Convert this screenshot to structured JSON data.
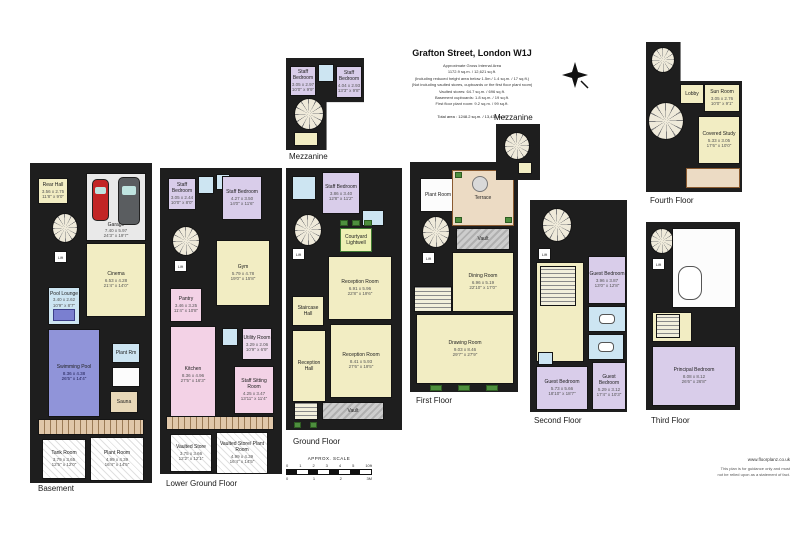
{
  "title_block": {
    "title": "Grafton Street, London W1J",
    "area_lines": [
      "Approximate Gross Internal Area",
      "1172.9 sq.m. / 12,621 sq.ft.",
      "(Including reduced height area below 1.5m / 1.4 sq.m. / 17 sq.ft.)",
      "(Not including vaulted stores, cupboards or the first floor plant room)",
      "Vaulted stores: 64.7 sq.m. / 696 sq.ft.",
      "Basement cupboards: 1.8 sq.m. / 19 sq.ft.",
      "First floor plant room: 9.2 sq.m. / 99 sq.ft."
    ],
    "total_line": "Total area : 1248.2 sq.m. / 13,438 sq.ft."
  },
  "scale_bar": {
    "label": "APPROX. SCALE",
    "feet_ticks": [
      "0",
      "1",
      "2",
      "3",
      "4",
      "5"
    ],
    "feet_unit": "10ft",
    "metre_ticks": [
      "0",
      "1",
      "2"
    ],
    "metre_unit": "3M"
  },
  "footer": {
    "website": "www.floorplanz.co.uk",
    "disclaimer_line1": "This plan is for guidance only and must",
    "disclaimer_line2": "not be relied upon as a statement of fact."
  },
  "common": {
    "lift": "Lift",
    "vault": "Vault"
  },
  "floors": {
    "basement": {
      "label": "Basement",
      "rooms": {
        "rear_hall": {
          "name": "Rear Hall",
          "m": "3.56 x 2.75",
          "ft": "11'8\" x 9'0\""
        },
        "garage": {
          "name": "Garage",
          "m": "7.40 x 5.97",
          "ft": "24'3\" x 19'7\""
        },
        "cinema": {
          "name": "Cinema",
          "m": "6.53 x 4.28",
          "ft": "21'4\" x 14'0\""
        },
        "pool_lounge": {
          "name": "Pool Lounge",
          "m": "3.40 x 2.62",
          "ft": "10'9\" x 8'7\""
        },
        "swimming_pool": {
          "name": "Swimming Pool",
          "m": "8.36 x 4.38",
          "ft": "26'5\" x 14'4\""
        },
        "plant_rm": {
          "name": "Plant Rm"
        },
        "sauna": {
          "name": "Sauna"
        },
        "tank_room": {
          "name": "Tank Room",
          "m": "3.79 x 3.65",
          "ft": "12'5\" x 12'0\""
        },
        "plant_room": {
          "name": "Plant Room",
          "m": "4.99 x 4.39",
          "ft": "16'4\" x 14'5\""
        }
      }
    },
    "lower_ground": {
      "label": "Lower Ground Floor",
      "rooms": {
        "staff_bedroom_1": {
          "name": "Staff Bedroom",
          "m": "3.05 x 2.44",
          "ft": "10'0\" x 8'0\""
        },
        "staff_bedroom_2": {
          "name": "Staff Bedroom",
          "m": "4.27 x 3.50",
          "ft": "14'0\" x 11'6\""
        },
        "gym": {
          "name": "Gym",
          "m": "5.79 x 4.78",
          "ft": "19'0\" x 15'8\""
        },
        "pantry": {
          "name": "Pantry",
          "m": "3.46 x 3.25",
          "ft": "11'4\" x 10'8\""
        },
        "kitchen": {
          "name": "Kitchen",
          "m": "8.36 x 4.96",
          "ft": "27'5\" x 16'3\""
        },
        "utility_room": {
          "name": "Utility Room",
          "m": "3.29 x 2.06",
          "ft": "10'9\" x 6'9\""
        },
        "staff_sitting_room": {
          "name": "Staff Sitting Room",
          "m": "4.25 x 3.47",
          "ft": "13'11\" x 11'4\""
        },
        "vaulted_store": {
          "name": "Vaulted Store",
          "m": "3.75 x 3.66",
          "ft": "12'2\" x 12'1\""
        },
        "vaulted_store_plant_room": {
          "name": "Vaulted Store/ Plant Room",
          "m": "4.99 x 4.39",
          "ft": "16'4\" x 14'5\""
        }
      }
    },
    "mezzanine_lower": {
      "label": "Mezzanine",
      "rooms": {
        "staff_bedroom_1": {
          "name": "Staff Bedroom",
          "m": "3.05 x 2.97",
          "ft": "10'0\" x 9'9\""
        },
        "staff_bedroom_2": {
          "name": "Staff Bedroom",
          "m": "4.04 x 2.93",
          "ft": "13'3\" x 9'8\""
        }
      }
    },
    "ground": {
      "label": "Ground Floor",
      "rooms": {
        "staff_bedroom": {
          "name": "Staff Bedroom",
          "m": "3.86 x 3.40",
          "ft": "12'8\" x 11'2\""
        },
        "courtyard_lightwell": {
          "name": "Courtyard Lightwell"
        },
        "reception_room_1": {
          "name": "Reception Room",
          "m": "6.91 x 5.96",
          "ft": "22'8\" x 19'6\""
        },
        "reception_room_2": {
          "name": "Reception Room",
          "m": "8.41 x 5.93",
          "ft": "27'6\" x 19'5\""
        },
        "staircase_hall": {
          "name": "Staircase Hall"
        },
        "reception_hall": {
          "name": "Reception Hall"
        },
        "vault": {
          "name": "Vault"
        }
      }
    },
    "first": {
      "label": "First Floor",
      "rooms": {
        "plant_room": {
          "name": "Plant Room"
        },
        "terrace": {
          "name": "Terrace"
        },
        "vault": {
          "name": "Vault"
        },
        "dining_room": {
          "name": "Dining Room",
          "m": "6.96 x 5.19",
          "ft": "22'10\" x 17'0\""
        },
        "drawing_room": {
          "name": "Drawing Room",
          "m": "9.03 x 8.46",
          "ft": "29'7\" x 27'9\""
        }
      }
    },
    "mezzanine_upper": {
      "label": "Mezzanine"
    },
    "second": {
      "label": "Second Floor",
      "rooms": {
        "guest_bedroom_1": {
          "name": "Guest Bedroom",
          "m": "3.96 x 3.87",
          "ft": "13'0\" x 12'8\""
        },
        "guest_bedroom_2": {
          "name": "Guest Bedroom",
          "m": "5.73 x 5.66",
          "ft": "18'10\" x 18'7\""
        },
        "guest_bedroom_3": {
          "name": "Guest Bedroom",
          "m": "5.29 x 3.12",
          "ft": "17'4\" x 10'3\""
        }
      }
    },
    "third": {
      "label": "Third Floor",
      "rooms": {
        "principal_bedroom": {
          "name": "Principal Bedroom",
          "m": "8.08 x 8.12",
          "ft": "26'6\" x 26'8\""
        }
      }
    },
    "fourth": {
      "label": "Fourth Floor",
      "rooms": {
        "lobby": {
          "name": "Lobby"
        },
        "sun_room": {
          "name": "Sun Room",
          "m": "3.05 x 2.76",
          "ft": "10'0\" x 9'1\""
        },
        "covered_study": {
          "name": "Covered Study",
          "m": "5.33 x 3.05",
          "ft": "17'6\" x 10'0\""
        }
      }
    }
  }
}
